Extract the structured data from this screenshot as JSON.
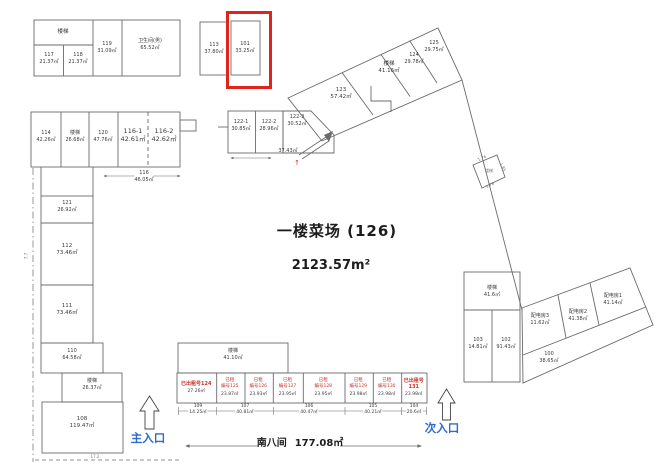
{
  "title": {
    "text": "一楼菜场 (126)",
    "area": "2123.57m²"
  },
  "colors": {
    "highlight": "#e0241b",
    "rented_text": "#cc3127",
    "entrance_text": "#2f6bd0",
    "line": "#6b6b6b"
  },
  "top_left": {
    "stairs": "楼梯",
    "cells": [
      {
        "id": "117",
        "area": "21.37㎡"
      },
      {
        "id": "118",
        "area": "21.37㎡"
      },
      {
        "id": "119",
        "area": "31.09㎡"
      },
      {
        "id": "卫生间(男)",
        "area": "65.52㎡"
      }
    ]
  },
  "top_pair": {
    "left": {
      "id": "113",
      "area": "37.80㎡"
    },
    "right": {
      "id": "101",
      "area": "33.25㎡"
    }
  },
  "mid_left": {
    "cells": [
      {
        "id": "114",
        "area": "42.26㎡"
      },
      {
        "id": "楼梯",
        "area": "26.68㎡"
      },
      {
        "id": "120",
        "area": "47.76㎡"
      },
      {
        "id": "116-1",
        "area": "42.61㎡"
      },
      {
        "id": "116-2",
        "area": "42.62㎡"
      }
    ],
    "dim": {
      "id": "116",
      "area": "46.05㎡"
    }
  },
  "left_col": {
    "cells": [
      {
        "id": "121",
        "area": "26.92㎡"
      },
      {
        "id": "112",
        "area": "73.46㎡"
      },
      {
        "id": "111",
        "area": "73.46㎡"
      },
      {
        "id": "110",
        "area": "64.58㎡"
      },
      {
        "id": "楼梯",
        "area": "26.37㎡"
      },
      {
        "id": "108",
        "area": "119.47㎡"
      }
    ],
    "dims": {
      "left": "7.7",
      "bottom": "17.2"
    }
  },
  "row_122": {
    "cells": [
      {
        "id": "122-1",
        "area": "30.85㎡"
      },
      {
        "id": "122-2",
        "area": "28.96㎡"
      },
      {
        "id": "122-3",
        "area": "30.52㎡"
      }
    ],
    "ramp_area": "37.43㎡",
    "arrow": "↑"
  },
  "band": {
    "cells": [
      {
        "id": "123",
        "area": "57.42㎡"
      },
      {
        "id": "楼梯",
        "area": "41.16㎡"
      },
      {
        "id": "124",
        "area": "29.78㎡"
      },
      {
        "id": "125",
        "area": "29.75㎡"
      }
    ]
  },
  "stair_shaft": {
    "id": "楼梯",
    "dims": [
      "1.76",
      "1.85",
      "1.76"
    ]
  },
  "right_block": {
    "cells": [
      {
        "id": "楼梯",
        "area": "41.6㎡"
      },
      {
        "id": "103",
        "area": "14.81㎡"
      },
      {
        "id": "102",
        "area": "91.43㎡"
      }
    ]
  },
  "tilted_block": {
    "cells": [
      {
        "id": "配电房3",
        "area": "11.62㎡"
      },
      {
        "id": "配电房2",
        "area": "41.38㎡"
      },
      {
        "id": "配电房1",
        "area": "41.14㎡"
      },
      {
        "id": "100",
        "area": "38.65㎡"
      }
    ]
  },
  "south": {
    "stairs": {
      "id": "楼梯",
      "area": "41.10㎡"
    },
    "stalls": [
      {
        "line1": "已出租号124",
        "line2": "",
        "area": "27.26㎡"
      },
      {
        "line1": "已租",
        "line2": "编号125",
        "area": "23.87㎡"
      },
      {
        "line1": "已租",
        "line2": "编号126",
        "area": "23.93㎡"
      },
      {
        "line1": "已租",
        "line2": "编号127",
        "area": "23.95㎡"
      },
      {
        "line1": "已租",
        "line2": "编号128",
        "area": "23.95㎡"
      },
      {
        "line1": "已租",
        "line2": "编号129",
        "area": "23.98㎡"
      },
      {
        "line1": "已租",
        "line2": "编号130",
        "area": "23.98㎡"
      },
      {
        "line1": "已出租号131",
        "line2": "",
        "area": "23.98㎡"
      }
    ],
    "dims": [
      {
        "id": "109",
        "area": "14.25㎡"
      },
      {
        "id": "107",
        "area": "40.81㎡"
      },
      {
        "id": "106",
        "area": "40.47㎡"
      },
      {
        "id": "105",
        "area": "40.21㎡"
      },
      {
        "id": "104",
        "area": "20.6㎡"
      }
    ],
    "label": "南八间",
    "label_area": "177.08㎡"
  },
  "entrances": {
    "main": "主入口",
    "secondary": "次入口"
  }
}
